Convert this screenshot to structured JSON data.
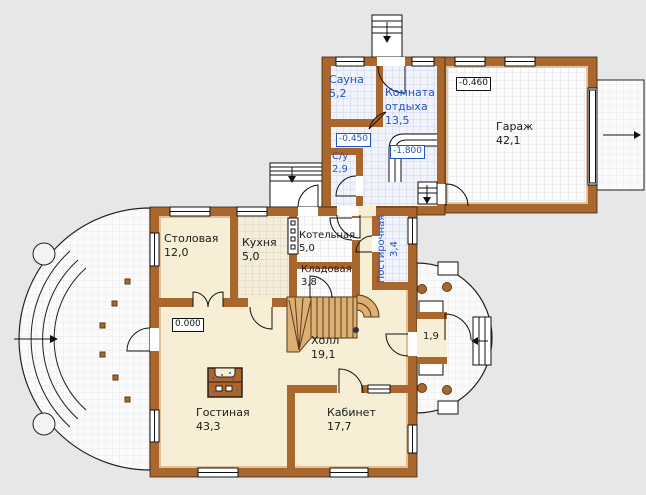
{
  "rooms": {
    "sauna": {
      "name": "Сауна",
      "area": "5,2"
    },
    "rest_room": {
      "name": "Комната отдыха",
      "area": "13,5"
    },
    "bathroom": {
      "name": "С/у",
      "area": "2,9"
    },
    "laundry": {
      "name": "Постирочная",
      "area": "3,4"
    },
    "garage": {
      "name": "Гараж",
      "area": "42,1"
    },
    "dining": {
      "name": "Столовая",
      "area": "12,0"
    },
    "kitchen": {
      "name": "Кухня",
      "area": "5,0"
    },
    "boiler": {
      "name": "Котельная",
      "area": "5,0"
    },
    "pantry": {
      "name": "Кладовая",
      "area": "3,8"
    },
    "hall": {
      "name": "Холл",
      "area": "19,1"
    },
    "living": {
      "name": "Гостиная",
      "area": "43,3"
    },
    "study": {
      "name": "Кабинет",
      "area": "17,7"
    }
  },
  "levels": {
    "garage": "-0.460",
    "sauna_lobby": "-0.450",
    "basement_stair": "-1.800",
    "ground": "0.000"
  },
  "dimensions": {
    "porch_width": "1,9"
  },
  "colors": {
    "wall": "#a9672e",
    "floor": "#f6efd6",
    "label_blue": "#2453c8",
    "background": "#e7e7e7"
  }
}
